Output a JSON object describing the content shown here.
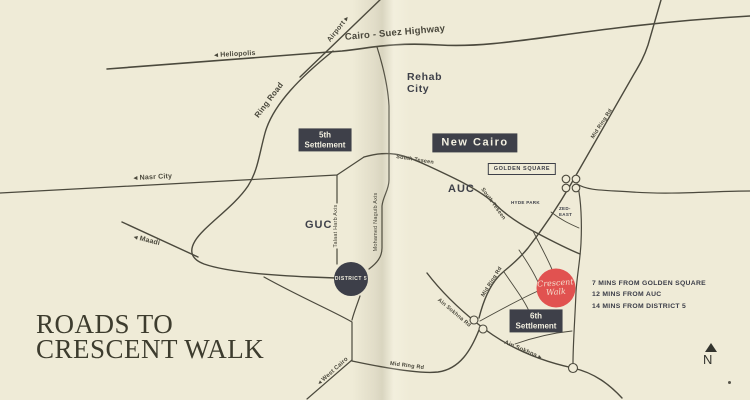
{
  "title": "ROADS TO\nCRESCENT WALK",
  "colors": {
    "background": "#efebd7",
    "road_ink": "#4b493d",
    "dark_label": "#3e4049",
    "label_text": "#f2efe0",
    "crescent_red": "#e15250",
    "title_ink": "#3d3c2e"
  },
  "area_labels": {
    "rehab_city": "Rehab\nCity",
    "new_cairo": "New Cairo",
    "fifth_settlement": "5th\nSettlement",
    "sixth_settlement": "6th\nSettlement",
    "golden_square": "GOLDEN SQUARE",
    "auc": "AUC",
    "guc": "GUC",
    "hyde_park": "HYDE PARK",
    "zed_east": "ZED-\nEAST"
  },
  "road_labels": {
    "cairo_suez": "Cairo - Suez Highway",
    "heliopolis": "◂ Heliopolis",
    "airport": "Airport ▸",
    "ring_road": "Ring Road",
    "nasr_city": "◂ Nasr City",
    "maadi": "◂ Maadi",
    "south_teseen_1": "South Teseen",
    "south_teseen_2": "South Teseen",
    "talaat_harb": "Talaat Harb Axis",
    "mohamed_naguib": "Mohamed Naguib Axis",
    "mid_ring_1": "Mid Ring Rd",
    "mid_ring_2": "Mid Ring Rd",
    "mid_ring_3": "Mid Ring Rd",
    "ain_sokhna_rd": "Ain Sokhna Rd",
    "ain_sokhna": "Ain Sokhna ▸",
    "west_cairo": "◂ West Cairo"
  },
  "markers": {
    "district5": "DISTRICT 5",
    "crescent_walk": "Crescent\nWalk"
  },
  "distances": [
    "7 MINS FROM GOLDEN SQUARE",
    "12 MINS FROM AUC",
    "14 MINS FROM DISTRICT 5"
  ],
  "compass": {
    "north": "N"
  }
}
